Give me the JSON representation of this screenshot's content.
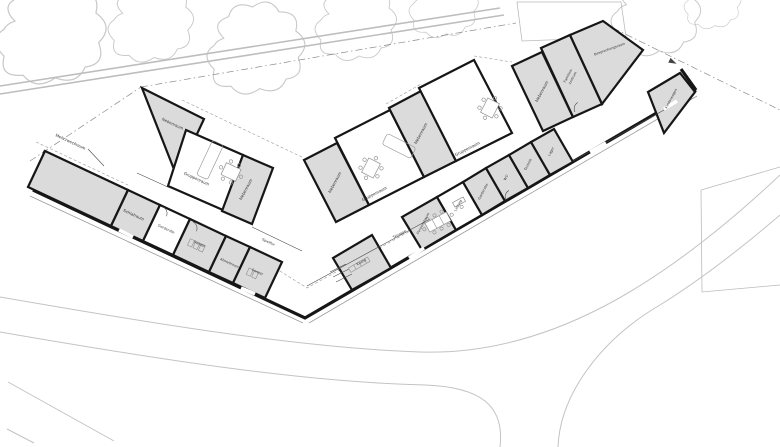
{
  "colors": {
    "background": "#ffffff",
    "room_fill": "#dbdbdb",
    "wall": "#161616",
    "thin_line": "#4a4a4a",
    "furniture": "#8f8f8f",
    "site_line": "#c3c3c3",
    "boundary": "#8a8a8a",
    "label": "#2e2e2e"
  },
  "plan": {
    "rooms": [
      {
        "label": "Mehrzweckraum"
      },
      {
        "label": "Schlafraum"
      },
      {
        "label": "Garderobe"
      },
      {
        "label": "Sanitär"
      },
      {
        "label": "Abstellraum"
      },
      {
        "label": "Nebenraum"
      },
      {
        "label": "Gruppenraum"
      },
      {
        "label": "Nebenraum"
      },
      {
        "label": "Nebenraum"
      },
      {
        "label": "Gruppenraum"
      },
      {
        "label": "Nebenraum"
      },
      {
        "label": "Gruppenraum"
      },
      {
        "label": "Nebenraum"
      },
      {
        "label": "Familien-",
        "label2": "zentrum"
      },
      {
        "label": "Besprechungsraum"
      },
      {
        "label": "Kinderwagen"
      },
      {
        "label": "Küche"
      },
      {
        "label": "Personalraum"
      },
      {
        "label": "Leitung"
      },
      {
        "label": "Garderobe"
      },
      {
        "label": "WC"
      },
      {
        "label": "Technik"
      },
      {
        "label": "Lager"
      },
      {
        "label": "Spielflur"
      },
      {
        "label": "Sanitär"
      },
      {
        "label": "Terrasse"
      }
    ]
  }
}
